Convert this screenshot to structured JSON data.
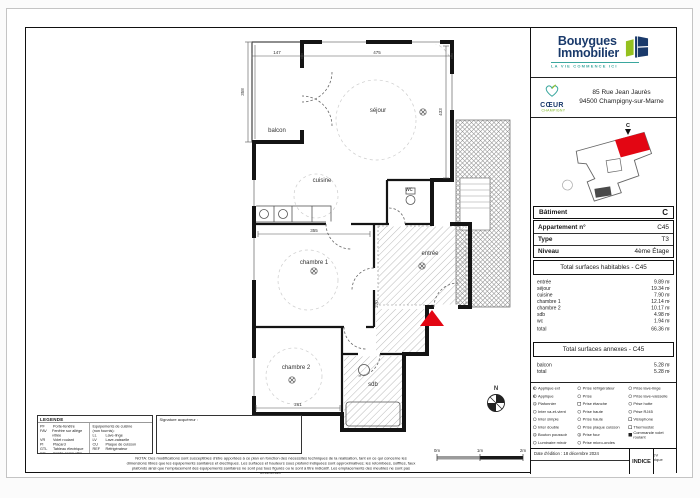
{
  "branding": {
    "name_line1": "Bouygues",
    "name_line2": "Immobilier",
    "tagline": "LA VIE COMMENCE ICI",
    "brand_navy": "#1a3a6b",
    "brand_green": "#95c11f",
    "brand_teal": "#3aa79e"
  },
  "program": {
    "name_line1": "CŒUR",
    "name_line2": "CHAMPIGNY"
  },
  "address": {
    "line1": "85 Rue Jean Jaurès",
    "line2": "94500 Champigny-sur-Marne"
  },
  "site_plan": {
    "marker": "C",
    "highlight_color": "#e30613"
  },
  "apartment": {
    "rows": [
      {
        "label": "Bâtiment",
        "value": "C"
      },
      {
        "label": "Appartement n°",
        "value": "C45"
      },
      {
        "label": "Type",
        "value": "T3"
      },
      {
        "label": "Niveau",
        "value": "4ème Étage"
      }
    ]
  },
  "surfaces_habitables": {
    "title": "Total surfaces habitables - C45",
    "rows": [
      {
        "label": "entrée",
        "value": "9.89 m²"
      },
      {
        "label": "séjour",
        "value": "19.34 m²"
      },
      {
        "label": "cuisine",
        "value": "7.90 m²"
      },
      {
        "label": "chambre 1",
        "value": "12.14 m²"
      },
      {
        "label": "chambre 2",
        "value": "10.17 m²"
      },
      {
        "label": "sdb",
        "value": "4.98 m²"
      },
      {
        "label": "wc",
        "value": "1.94 m²"
      },
      {
        "label": "total",
        "value": "66.36 m²"
      }
    ]
  },
  "surfaces_annexes": {
    "title": "Total surfaces annexes - C45",
    "rows": [
      {
        "label": "balcon",
        "value": "5.28 m²"
      },
      {
        "label": "total",
        "value": "5.28 m²"
      }
    ]
  },
  "electric_legend": {
    "col1": [
      {
        "icon": "wall-light-ext-icon",
        "label": "Applique ext"
      },
      {
        "icon": "wall-light-icon",
        "label": "Applique"
      },
      {
        "icon": "ceiling-light-icon",
        "label": "Plafonnier"
      },
      {
        "icon": "switch-two-way-icon",
        "label": "Inter va-et-vient"
      },
      {
        "icon": "switch-single-icon",
        "label": "Inter simple"
      },
      {
        "icon": "switch-double-icon",
        "label": "Inter double"
      },
      {
        "icon": "push-button-icon",
        "label": "Bouton poussoir"
      },
      {
        "icon": "mirror-light-icon",
        "label": "Luminaire miroir"
      }
    ],
    "col2": [
      {
        "icon": "socket-fridge-icon",
        "label": "Prise réfrigérateur"
      },
      {
        "icon": "socket-icon",
        "label": "Prise"
      },
      {
        "icon": "socket-waterproof-icon",
        "label": "Prise étanche"
      },
      {
        "icon": "socket-high-icon",
        "label": "Prise haute"
      },
      {
        "icon": "socket-high-icon",
        "label": "Prise haute"
      },
      {
        "icon": "socket-hob-icon",
        "label": "Prise plaque cuisson"
      },
      {
        "icon": "socket-oven-icon",
        "label": "Prise four"
      },
      {
        "icon": "socket-microwave-icon",
        "label": "Prise micro-ondes"
      }
    ],
    "col3": [
      {
        "icon": "socket-washer-icon",
        "label": "Prise lave-linge"
      },
      {
        "icon": "socket-dishwasher-icon",
        "label": "Prise lave-vaisselle"
      },
      {
        "icon": "socket-hood-icon",
        "label": "Prise hotte"
      },
      {
        "icon": "socket-rj45-icon",
        "label": "Prise RJ45"
      },
      {
        "icon": "videophone-icon",
        "label": "Visiophone"
      },
      {
        "icon": "thermostat-icon",
        "label": "Thermostat"
      },
      {
        "icon": "shutter-control-icon",
        "label": "Commande volet roulant"
      }
    ]
  },
  "footer": {
    "date": "Date d'édition : 18 décembre 2024",
    "indice": "INDICE",
    "pdv": "PDV technique"
  },
  "legende": {
    "title": "LEGENDE",
    "items": [
      {
        "abbr": "PF",
        "label": "Porte-fenêtre"
      },
      {
        "abbr": "FAV",
        "label": "Fenêtre sur allège vitrée"
      },
      {
        "abbr": "VR",
        "label": "Volet roulant"
      },
      {
        "abbr": "Pl",
        "label": "Placard"
      },
      {
        "abbr": "GTL",
        "label": "Tableau électrique"
      },
      {
        "abbr": "GC",
        "label": "Garde-corps vitré"
      },
      {
        "abbr": "FP",
        "label": "Faux plafond"
      }
    ],
    "kitchen_title_1": "Equipements de cuisine",
    "kitchen_title_2": "(non fournis):",
    "kitchen_items": [
      {
        "abbr": "LL",
        "label": "Lave-linge"
      },
      {
        "abbr": "LV",
        "label": "Lave-vaisselle"
      },
      {
        "abbr": "CU",
        "label": "Plaque de cuisson"
      },
      {
        "abbr": "REF",
        "label": "Réfrigérateur"
      }
    ],
    "signature": "Signature acquéreur :"
  },
  "nota": {
    "text": "NOTA: Des modifications sont susceptibles d'être apportées à ce plan en fonction des nécessités techniques de la réalisation, tant en ce qui concerne les dimensions libres que les équipements sanitaires et électriques. Les surfaces et hauteurs sous plafond indiquées sont approximatives; les retombées, soffites, faux plafonds ainsi que l'emplacement des équipements sanitaires ne sont pas tous figurés ou le sont à titre indicatif. Les emplacements des meubles ne sont pas représentés."
  },
  "plan": {
    "rooms": {
      "balcon": "balcon",
      "sejour": "séjour",
      "cuisine": "cuisine",
      "wc": "wc",
      "entree": "entrée",
      "chambre1": "chambre 1",
      "chambre2": "chambre 2",
      "sdb": "sdb"
    },
    "dims": {
      "top_balcon": "147",
      "top_sejour": "475",
      "left": "358",
      "right": "433",
      "chambre1": "355",
      "chambre2": "261",
      "corridor": "270"
    },
    "compass": "N",
    "scale": {
      "zero": "0m",
      "one": "1m",
      "two": "2m"
    },
    "entry_marker_color": "#e30613"
  }
}
